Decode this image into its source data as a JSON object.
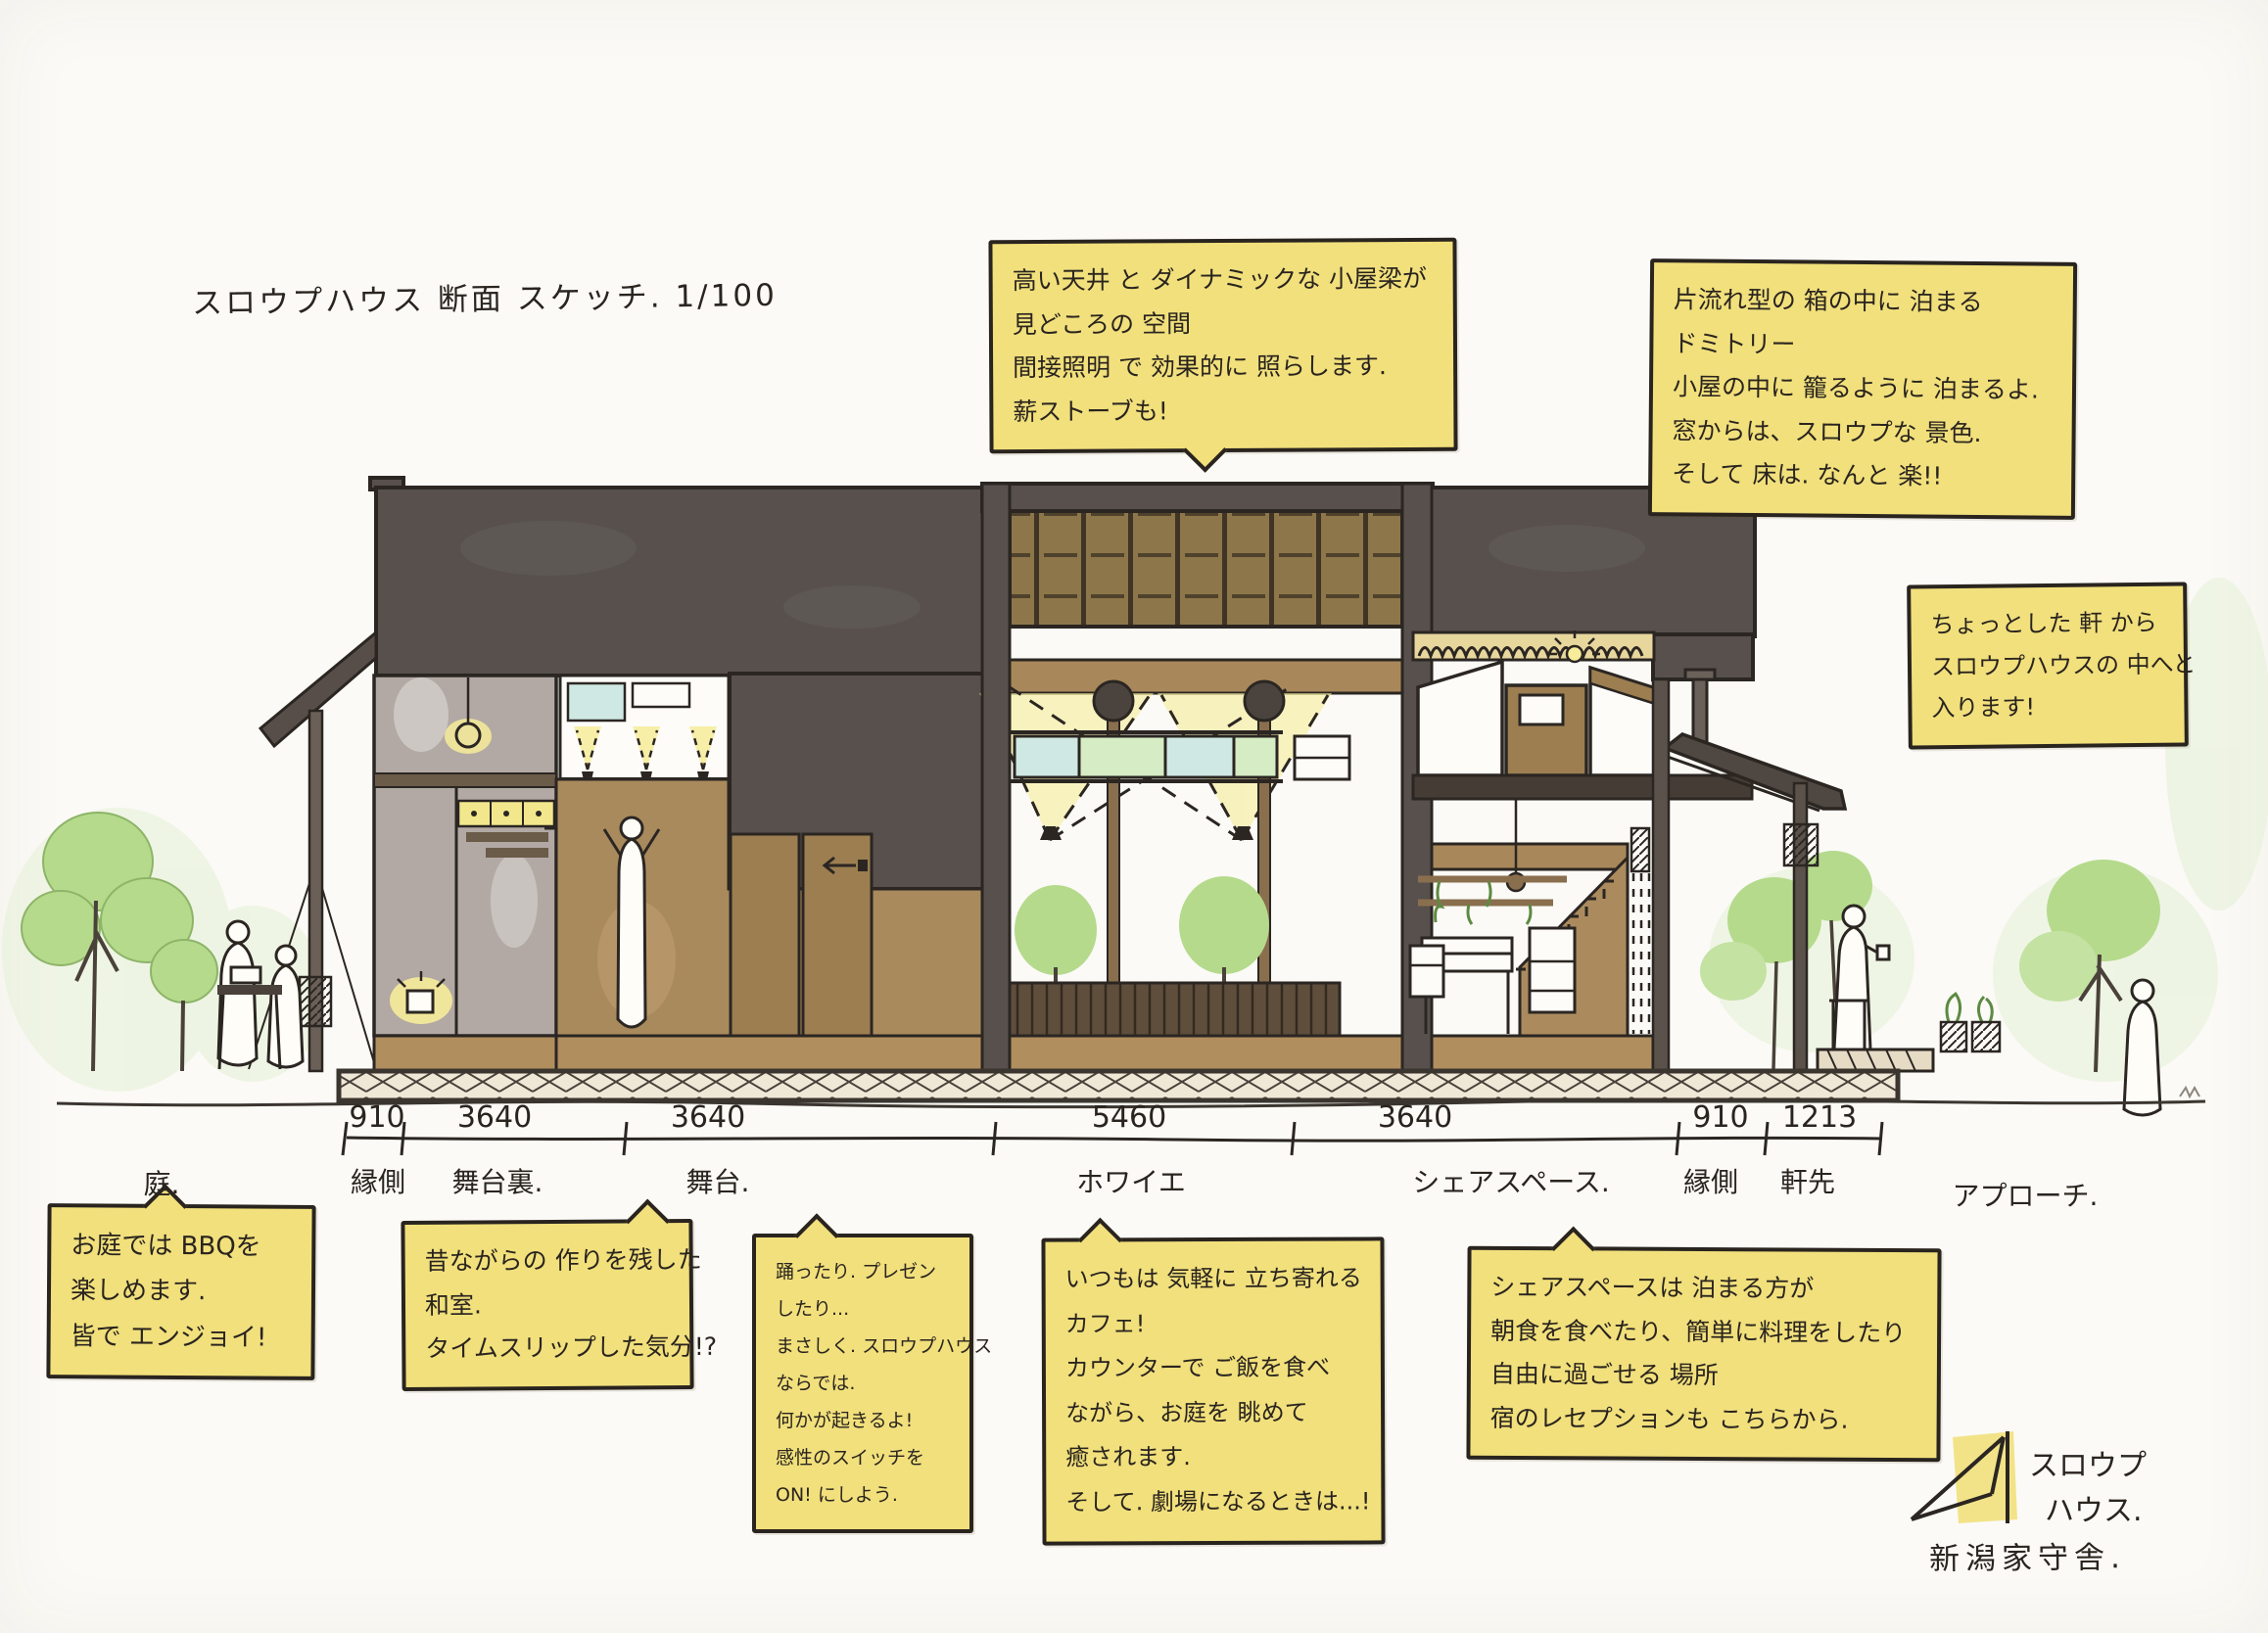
{
  "title": "スロウプハウス 断面 スケッチ. 1/100",
  "notes": {
    "ceiling": {
      "lines": [
        "高い天井 と ダイナミックな 小屋梁が",
        "見どころの 空間",
        "間接照明 で 効果的に 照らします.",
        "薪ストーブも!"
      ]
    },
    "dormitory": {
      "lines": [
        "片流れ型の 箱の中に 泊まる",
        "ドミトリー",
        "小屋の中に 籠るように 泊まるよ.",
        "窓からは、スロウプな 景色.",
        "そして 床は. なんと 楽!!"
      ]
    },
    "entrance": {
      "lines": [
        "ちょっとした 軒 から",
        "スロウプハウスの 中へと",
        "入ります!"
      ]
    },
    "garden": {
      "lines": [
        "お庭では BBQを",
        "楽しめます.",
        "皆で エンジョイ!"
      ]
    },
    "washitsu": {
      "lines": [
        "昔ながらの 作りを残した",
        "和室.",
        "タイムスリップした気分!?"
      ]
    },
    "stage": {
      "lines": [
        "踊ったり. プレゼン",
        "したり...",
        "まさしく. スロウプハウス",
        "ならでは.",
        "何かが起きるよ!",
        "感性のスイッチを",
        "ON! にしよう."
      ]
    },
    "cafe": {
      "lines": [
        "いつもは 気軽に 立ち寄れる",
        "カフェ!",
        "カウンターで ご飯を食べ",
        "ながら、お庭を 眺めて",
        "癒されます.",
        "そして. 劇場になるときは...!"
      ]
    },
    "share": {
      "lines": [
        "シェアスペースは 泊まる方が",
        "朝食を食べたり、簡単に料理をしたり",
        "自由に過ごせる 場所",
        "宿のレセプションも こちらから."
      ]
    }
  },
  "dimensions": {
    "segments": [
      {
        "value": "910",
        "label": "縁側"
      },
      {
        "value": "3640",
        "label": "舞台裏."
      },
      {
        "value": "3640",
        "label": "舞台."
      },
      {
        "value": "5460",
        "label": "ホワイエ"
      },
      {
        "value": "3640",
        "label": "シェアスペース."
      },
      {
        "value": "910",
        "label": "縁側"
      },
      {
        "value": "1213",
        "label": "軒先"
      }
    ]
  },
  "site_labels": {
    "garden": "庭.",
    "approach": "アプローチ."
  },
  "logo": {
    "line1": "スロウプ",
    "line2": "ハウス.",
    "company": "新潟家守舎."
  },
  "colors": {
    "paper": "#fbfaf6",
    "ink": "#2a241f",
    "note_yellow": "#f1e07c",
    "roof_dark": "#57504d",
    "wood_tan": "#a8885a",
    "wall_brown": "#a98a5d",
    "glow_yellow": "#f6ec9a",
    "tree_green": "#b5da8c",
    "glass_blue": "#cfe8e3",
    "glass_green": "#d6ecc4"
  }
}
